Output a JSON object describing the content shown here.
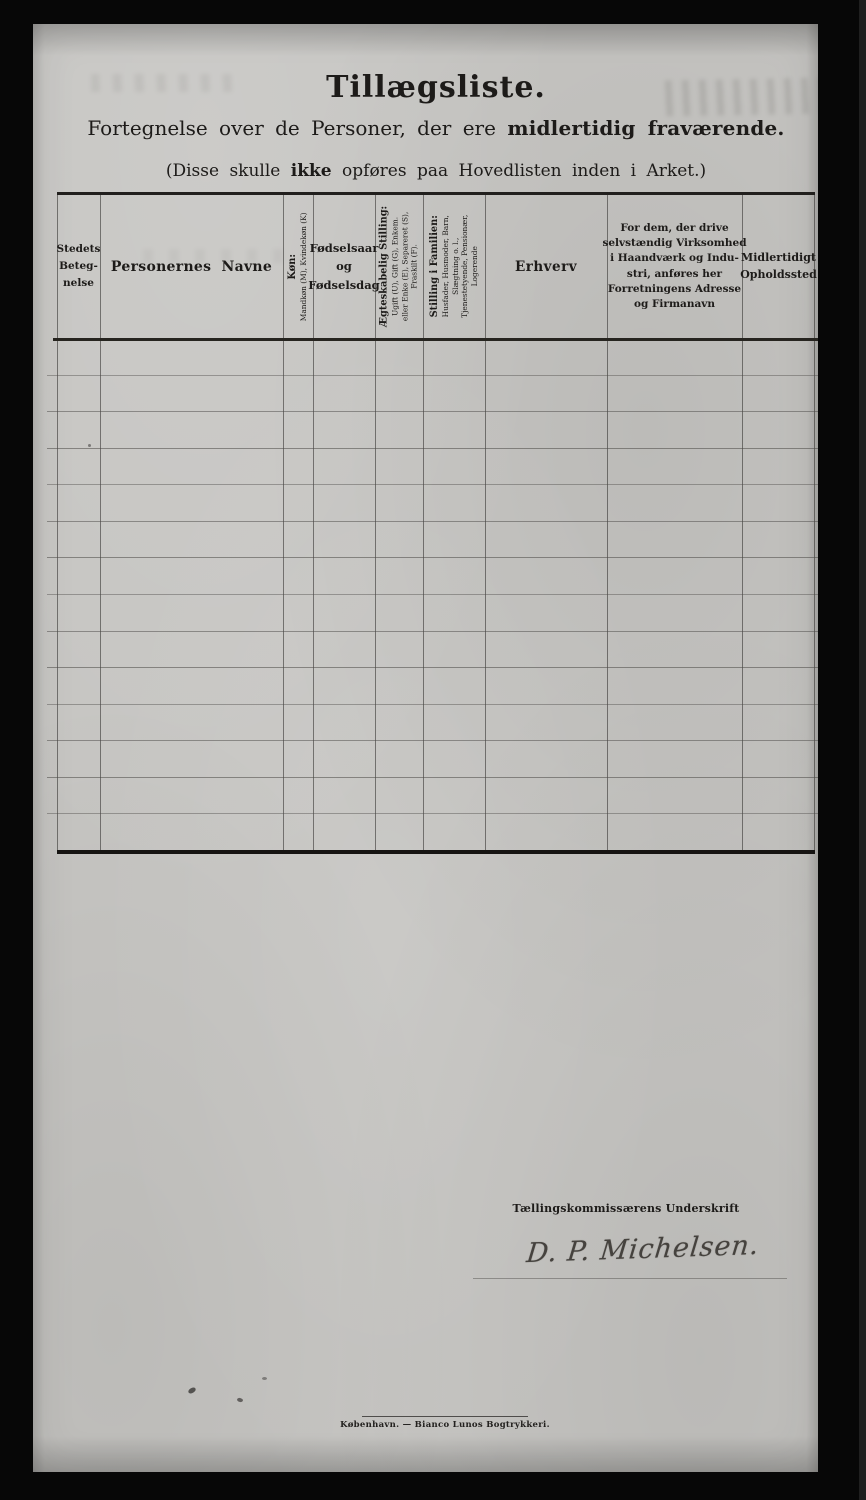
{
  "document": {
    "title": "Tillægsliste.",
    "subtitle": {
      "regular": "Fortegnelse over de Personer, der ere",
      "bold": "midlertidig fraværende."
    },
    "note": {
      "pre": "(Disse skulle",
      "bold": "ikke",
      "post": "opføres paa Hovedlisten inden i Arket.)"
    }
  },
  "table": {
    "row_count": 14,
    "columns": [
      {
        "name": "stedets-betegnelse",
        "rotated": false,
        "lines": [
          "Stedets",
          "Beteg-",
          "nelse"
        ]
      },
      {
        "name": "personernes-navne",
        "rotated": false,
        "lines": [
          "Personernes Navne"
        ]
      },
      {
        "name": "kon",
        "rotated": true,
        "title": "Køn:",
        "subs": [
          "Mandkøn (M), Kvindekøn (K)"
        ]
      },
      {
        "name": "fodselsaar-og-fodselsdag",
        "rotated": false,
        "lines": [
          "Fødselsaar",
          "og",
          "Fødselsdag"
        ]
      },
      {
        "name": "aegteskabelig-stilling",
        "rotated": true,
        "title": "Ægteskabelig Stilling:",
        "subs": [
          "Ugift (U), Gift (G), Enkem.",
          "eller Enke (E), Separeret (S),",
          "Fraskilt (F)."
        ]
      },
      {
        "name": "stilling-i-familien",
        "rotated": true,
        "title": "Stilling i Familien:",
        "subs": [
          "Husfader, Husmoder, Barn,",
          "Slægtning o. l.,",
          "Tjenestetyende, Pensionær,",
          "Logerende"
        ]
      },
      {
        "name": "erhverv",
        "rotated": false,
        "lines": [
          "Erhverv"
        ]
      },
      {
        "name": "virksomhed-adresse-firmanavn",
        "rotated": false,
        "lines": [
          "For dem, der drive",
          "selvstændig Virksomhed",
          "i Haandværk og Indu-",
          "stri, anføres her",
          "Forretningens Adresse",
          "og Firmanavn"
        ]
      },
      {
        "name": "midlertidigt-opholdssted",
        "rotated": false,
        "lines": [
          "Midlertidigt",
          "Opholdssted"
        ]
      }
    ]
  },
  "signature": {
    "label": "Tællingskommissærens Underskrift",
    "value": "D. P. Michelsen."
  },
  "imprint": "København. — Bianco Lunos Bogtrykkeri.",
  "colors": {
    "paper": "#c6c5c2",
    "ink": "#1d1b19",
    "grid_line": "#4a4845",
    "thick_line": "#211f1d",
    "background": "#070707"
  }
}
